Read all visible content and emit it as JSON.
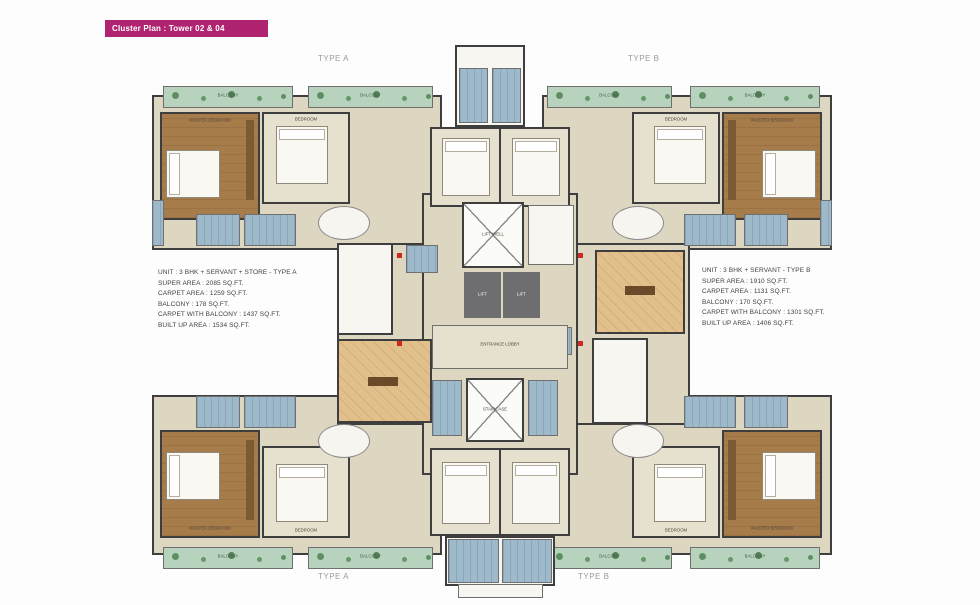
{
  "title_bar": {
    "label": "Cluster Plan : Tower 02 & 04"
  },
  "type_labels": {
    "top_left": "TYPE A",
    "top_right": "TYPE B",
    "bottom_left": "TYPE A",
    "bottom_right": "TYPE B"
  },
  "unit_specs": {
    "type_a": {
      "lines": [
        "UNIT : 3 BHK + SERVANT + STORE - TYPE A",
        "SUPER AREA : 2085 SQ.FT.",
        "CARPET AREA : 1259 SQ.FT.",
        "BALCONY : 178 SQ.FT.",
        "CARPET WITH BALCONY : 1437 SQ.FT.",
        "BUILT UP AREA : 1534 SQ.FT."
      ]
    },
    "type_b": {
      "lines": [
        "UNIT : 3 BHK + SERVANT - TYPE B",
        "SUPER AREA : 1910 SQ.FT.",
        "CARPET AREA : 1131 SQ.FT.",
        "BALCONY : 170 SQ.FT.",
        "CARPET WITH BALCONY : 1301 SQ.FT.",
        "BUILT UP AREA : 1406 SQ.FT."
      ]
    }
  },
  "room_labels": {
    "balcony": "BALCONY",
    "master_bedroom": "MASTER BEDROOM",
    "bedroom": "BEDROOM",
    "entrance_lobby": "ENTRANCE LOBBY",
    "lift": "LIFT",
    "lift_well": "LIFT WELL",
    "staircase": "STAIRCASE"
  },
  "colors": {
    "accent_magenta": "#b02371",
    "wall": "#3e3e3e",
    "floor_beige": "#ddd6c1",
    "wood_brown": "#a67c4b",
    "tan": "#e2c08c",
    "bath_blue": "#9db9ca",
    "balcony_green": "#b7d3bd",
    "lift_gray": "#6e6e70",
    "entry_marker_red": "#cc2a1e"
  }
}
